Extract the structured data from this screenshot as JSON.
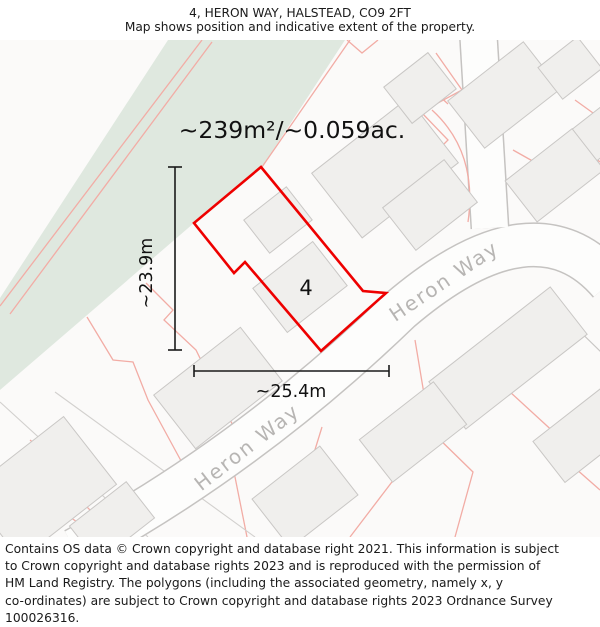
{
  "title": {
    "lines": [
      "4, HERON WAY, HALSTEAD, CO9 2FT",
      "Map shows position and indicative extent of the property."
    ]
  },
  "map": {
    "area_label": "~239m²/~0.059ac.",
    "plot_number": "4",
    "width_label": "~25.4m",
    "height_label": "~23.9m",
    "street_labels": [
      "Heron Way",
      "Heron Way"
    ],
    "colors": {
      "property_outline": "#ee0000",
      "parcel_line": "#f2aca5",
      "vegetation_fill": "#dfe8df",
      "building_fill": "#f0efed",
      "building_stroke": "#c9c7c5",
      "road_casing": "#c5c3c1",
      "road_fill": "#fdfdfc",
      "map_background": "#fbfaf9",
      "street_label": "#b7b5b3",
      "dimension_line": "#1a1a1a"
    }
  },
  "footer": {
    "lines": [
      "Contains OS data © Crown copyright and database right 2021. This information is subject",
      "to Crown copyright and database rights 2023 and is reproduced with the permission of",
      "HM Land Registry. The polygons (including the associated geometry, namely x, y",
      "co-ordinates) are subject to Crown copyright and database rights 2023 Ordnance Survey",
      "100026316."
    ]
  }
}
